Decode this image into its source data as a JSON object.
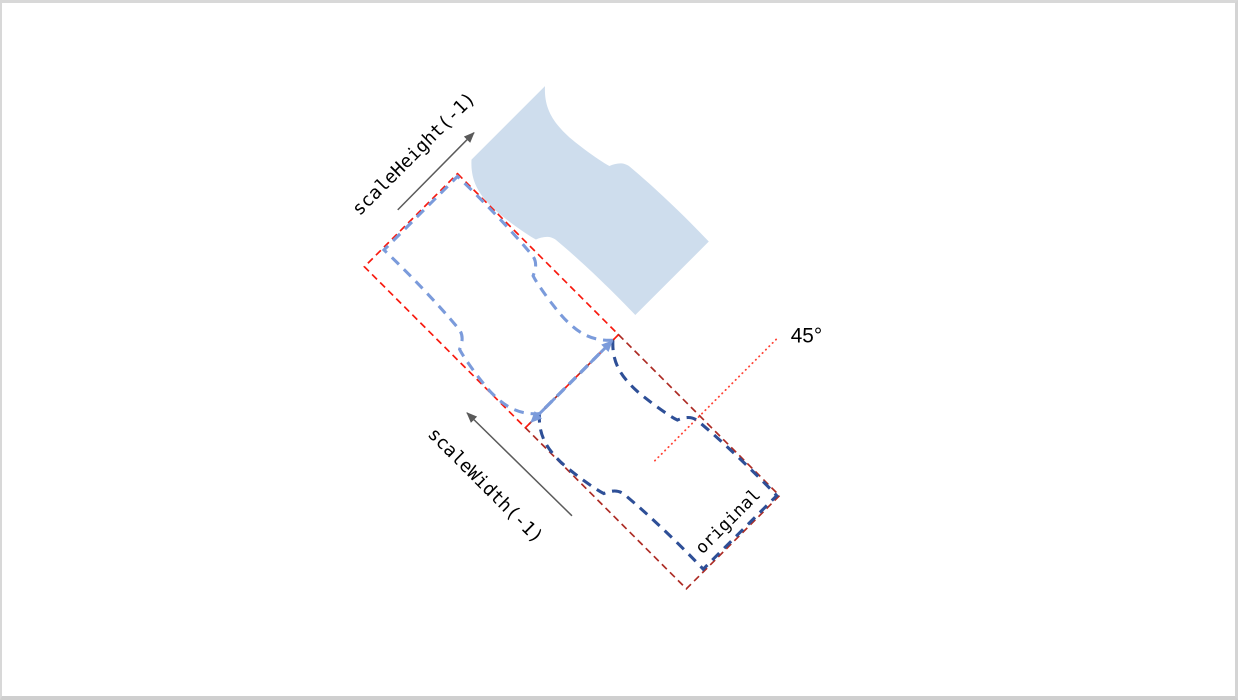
{
  "canvas": {
    "background": "#ffffff",
    "border_color": "#d6d6d6"
  },
  "diagram": {
    "labels": {
      "scale_height": "scaleHeight(-1)",
      "scale_width": "scaleWidth(-1)",
      "original": "original",
      "angle": "45°"
    },
    "rotation_degrees": "45",
    "colors": {
      "flag_fill": "#cedded",
      "mirrored_flag_stroke": "#7b9bdb",
      "original_flag_stroke": "#2e4f97",
      "bbox_upper_stroke": "#f8190e",
      "bbox_lower_stroke": "#ad2b24",
      "angle_line": "#ff4336",
      "mirror_axis_arrow": "#7b9bdb",
      "gray_arrow": "#5a5a5a",
      "text": "#000000"
    }
  }
}
